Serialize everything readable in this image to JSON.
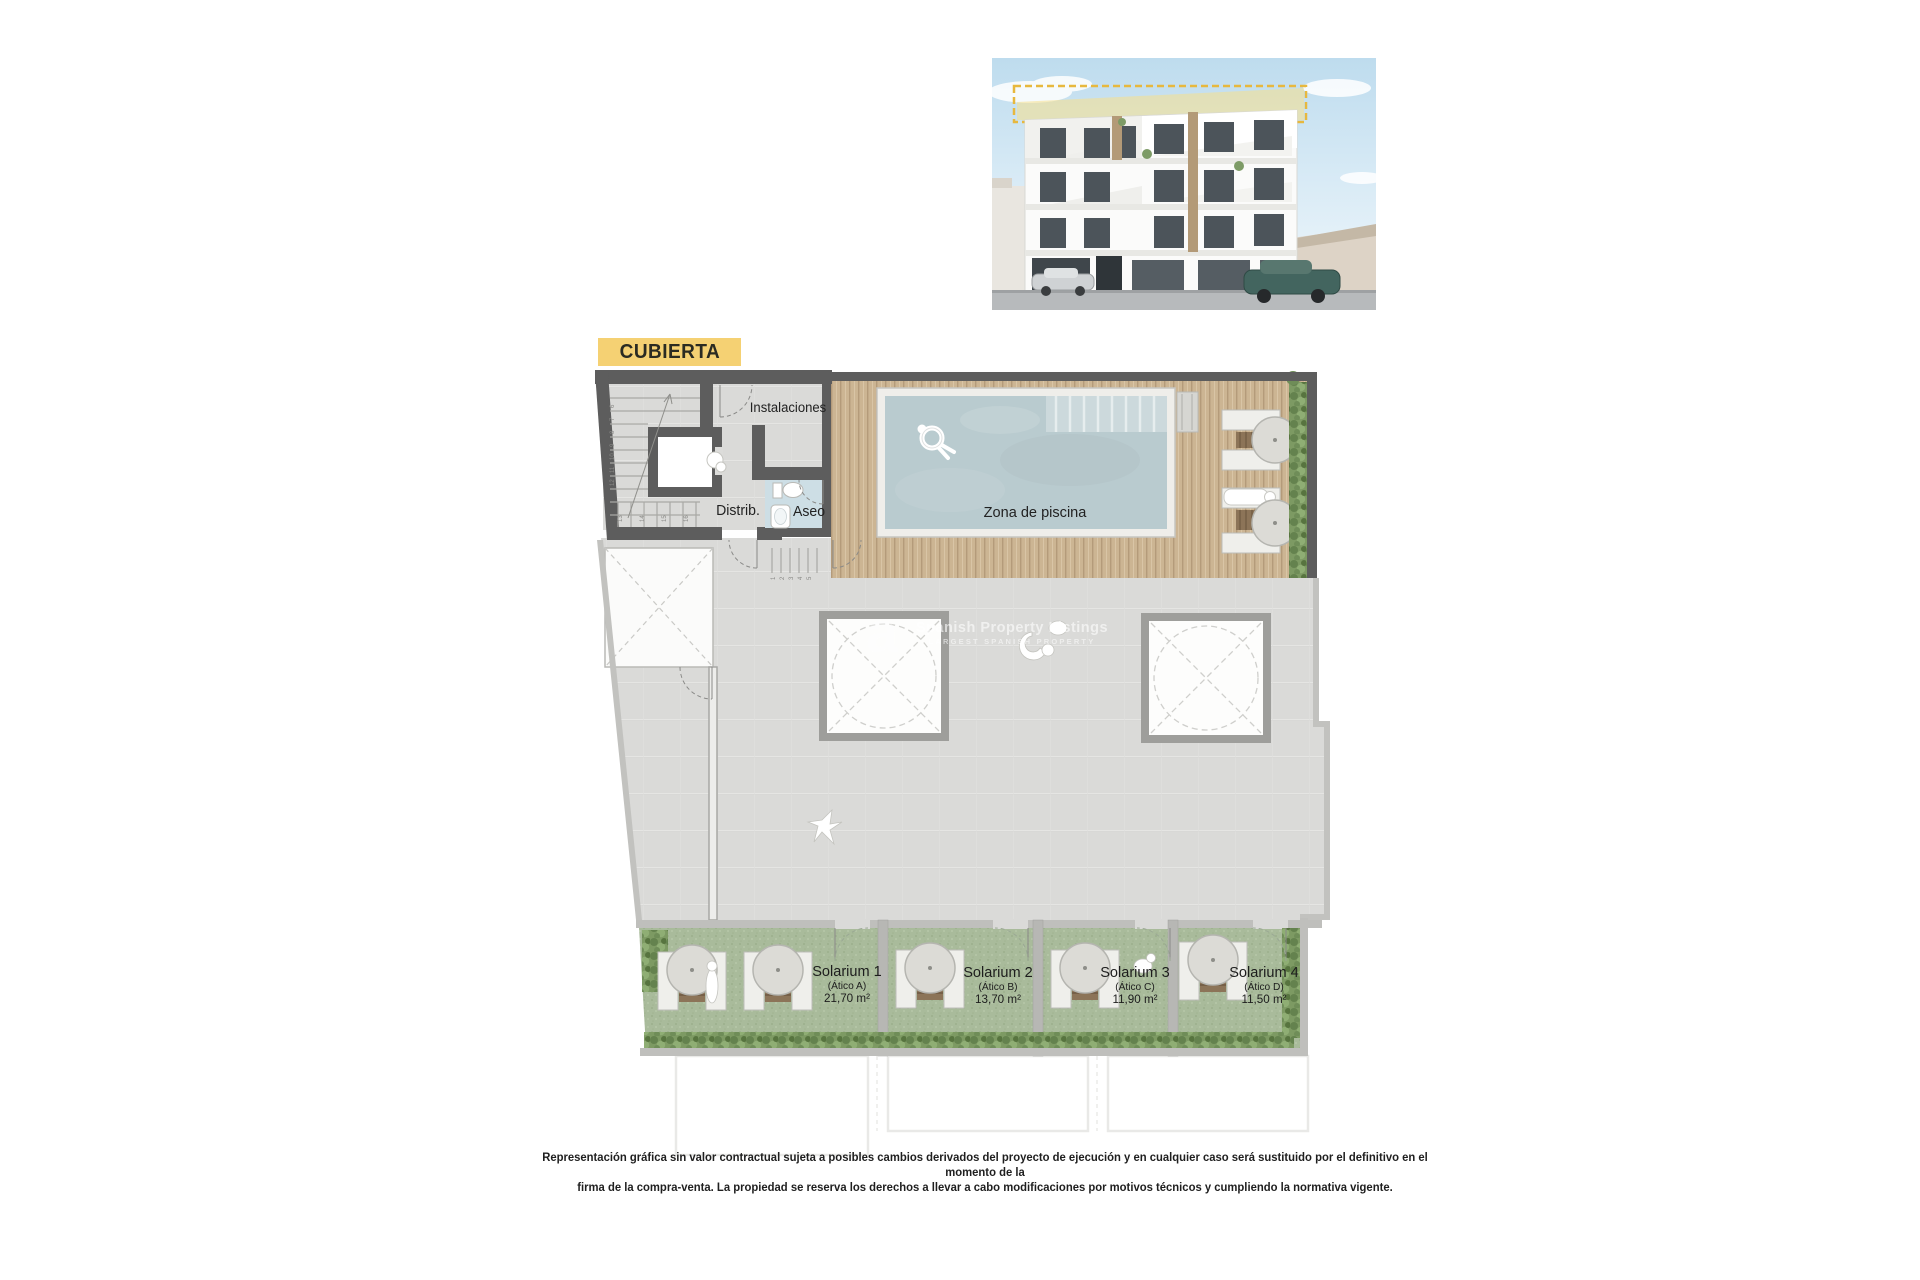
{
  "header": {
    "title": "CUBIERTA"
  },
  "plan": {
    "labels": {
      "installations": "Instalaciones",
      "distrib": "Distrib.",
      "aseo": "Aseo",
      "pool": "Zona de piscina"
    },
    "solariums": [
      {
        "name": "Solarium 1",
        "unit": "(Ático A)",
        "area": "21,70 m²"
      },
      {
        "name": "Solarium 2",
        "unit": "(Ático B)",
        "area": "13,70 m²"
      },
      {
        "name": "Solarium 3",
        "unit": "(Ático C)",
        "area": "11,90 m²"
      },
      {
        "name": "Solarium 4",
        "unit": "(Ático D)",
        "area": "11,50 m²"
      }
    ],
    "stair_side_numbers": [
      "6",
      "7",
      "8",
      "9",
      "10",
      "11",
      "12"
    ],
    "stair_bottom_numbers": [
      "13",
      "14",
      "15",
      "16"
    ],
    "deck_step_numbers": [
      "1",
      "2",
      "3",
      "4",
      "5"
    ],
    "colors": {
      "highlight_yellow": "#f5d173",
      "wall_dark": "#5d5d5d",
      "wall_light": "#bfbfbc",
      "tile": "#dadad8",
      "wood_deck": "#ccb593",
      "pool_water": "#b9cbcf",
      "grass": "#a9bb9b",
      "hedge": "#6a8853",
      "aseo_floor": "#cddee5",
      "render_dashed_accent": "#e7b83e"
    }
  },
  "watermark": {
    "logo_glyph": "a",
    "line1": "Spanish Property Listings",
    "line2": "LARGEST SPANISH PROPERTY"
  },
  "disclaimer": {
    "line1": "Representación gráfica sin valor contractual sujeta a posibles cambios derivados del proyecto de ejecución y en cualquier caso será sustituido por el definitivo en el momento de la",
    "line2": "firma de la compra-venta. La propiedad se reserva los derechos a llevar a cabo modificaciones por motivos técnicos y cumpliendo la normativa vigente."
  }
}
